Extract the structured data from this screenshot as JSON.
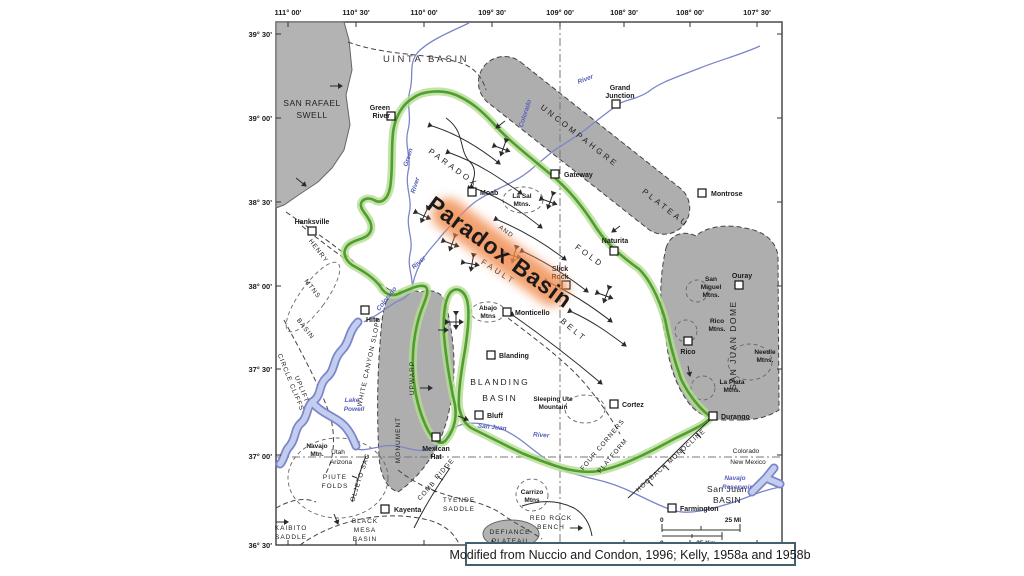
{
  "caption": "Modified from Nuccio and Condon, 1996; Kelly, 1958a and 1958b",
  "highlight": "Paradox Basin",
  "colors": {
    "basin_outline": "#4f9e2f",
    "highlight_glow": "#f0884a",
    "water": "#7b86c8",
    "uplift_fill": "#b3b3b3"
  },
  "axes": {
    "lon": [
      "111° 00'",
      "110° 30'",
      "110° 00'",
      "109° 30'",
      "109° 00'",
      "108° 30'",
      "108° 00'",
      "107° 30'"
    ],
    "lat": [
      "39° 30'",
      "39° 00'",
      "38° 30'",
      "38° 00'",
      "37° 30'",
      "37° 00'",
      "36° 30'"
    ]
  },
  "labels": {
    "uinta": "UINTA BASIN",
    "san_rafael": [
      "SAN RAFAEL",
      "SWELL"
    ],
    "uncompahgre": "UNCOMPAHGRE",
    "plateau": "PLATEAU",
    "paradox": "PARADOX",
    "fold": "FOLD",
    "and": "AND",
    "fault": "FAULT",
    "belt": "BELT",
    "henry": [
      "HENRY",
      "MTNS",
      "BASIN"
    ],
    "circle_cliffs": [
      "CIRCLE CLIFFS",
      "UPLIFT"
    ],
    "white_canyon": "WHITE CANYON SLOPE",
    "monument": "MONUMENT",
    "upwarp": "UPWARP",
    "blanding_basin": [
      "BLANDING",
      "BASIN"
    ],
    "four_corners": [
      "FOUR CORNERS",
      "PLATFORM"
    ],
    "hogback": "HOGBACK MONOCLINE",
    "san_juan_dome": "SAN JUAN DOME",
    "san_juan_basin": [
      "San Juan",
      "BASIN"
    ],
    "oljeto": "OLJETO SAG",
    "comb": [
      "COMB",
      "RIDGE"
    ],
    "tyende": [
      "TYENDE",
      "SADDLE"
    ],
    "piute": [
      "PIUTE",
      "FOLDS"
    ],
    "kaibito": [
      "KAIBITO",
      "SADDLE"
    ],
    "black_mesa": [
      "BLACK",
      "MESA",
      "BASIN"
    ],
    "red_rock": [
      "RED ROCK",
      "BENCH"
    ],
    "defiance": [
      "DEFIANCE",
      "PLATEAU"
    ]
  },
  "states": {
    "utah": "Utah",
    "arizona": "Arizona",
    "colorado": "Colorado",
    "new_mexico": "New Mexico"
  },
  "towns": {
    "green_river": [
      "Green",
      "River"
    ],
    "grand_junction": [
      "Grand",
      "Junction"
    ],
    "moab": "Moab",
    "gateway": "Gateway",
    "montrose": "Montrose",
    "naturita": "Naturita",
    "slick_rock": [
      "Slick",
      "Rock"
    ],
    "monticello": "Monticello",
    "blanding": "Blanding",
    "hanksville": "Hanksville",
    "hite": "Hite",
    "bluff": "Bluff",
    "mexican_hat": [
      "Mexican",
      "Hat"
    ],
    "kayenta": "Kayenta",
    "cortez": "Cortez",
    "durango": "Durango",
    "farmington": "Farmington",
    "ouray": "Ouray",
    "rico": "Rico"
  },
  "mountains": {
    "la_sal": [
      "La Sal",
      "Mtns."
    ],
    "abajo": [
      "Abajo",
      "Mtns"
    ],
    "navajo": [
      "Navajo",
      "Mtn."
    ],
    "sleeping_ute": [
      "Sleeping Ute",
      "Mountain"
    ],
    "carrizo": [
      "Carrizo",
      "Mtns"
    ],
    "san_miguel": [
      "San",
      "Miguel",
      "Mtns."
    ],
    "rico_mtns": [
      "Rico",
      "Mtns."
    ],
    "needle": [
      "Needle",
      "Mtns."
    ],
    "la_plata": [
      "La Plata",
      "Mtns."
    ]
  },
  "water": {
    "green_river": [
      "Green",
      "River"
    ],
    "colorado_upper": [
      "Colorado",
      "River"
    ],
    "colorado_lower": [
      "Colorado",
      "River"
    ],
    "san_juan": [
      "San Juan",
      "River"
    ],
    "lake_powell": [
      "Lake",
      "Powell"
    ],
    "navajo_reservoir": [
      "Navajo",
      "Reservoir"
    ]
  },
  "scale": {
    "zero": "0",
    "mi": "25 MI",
    "km": "25 Km"
  }
}
